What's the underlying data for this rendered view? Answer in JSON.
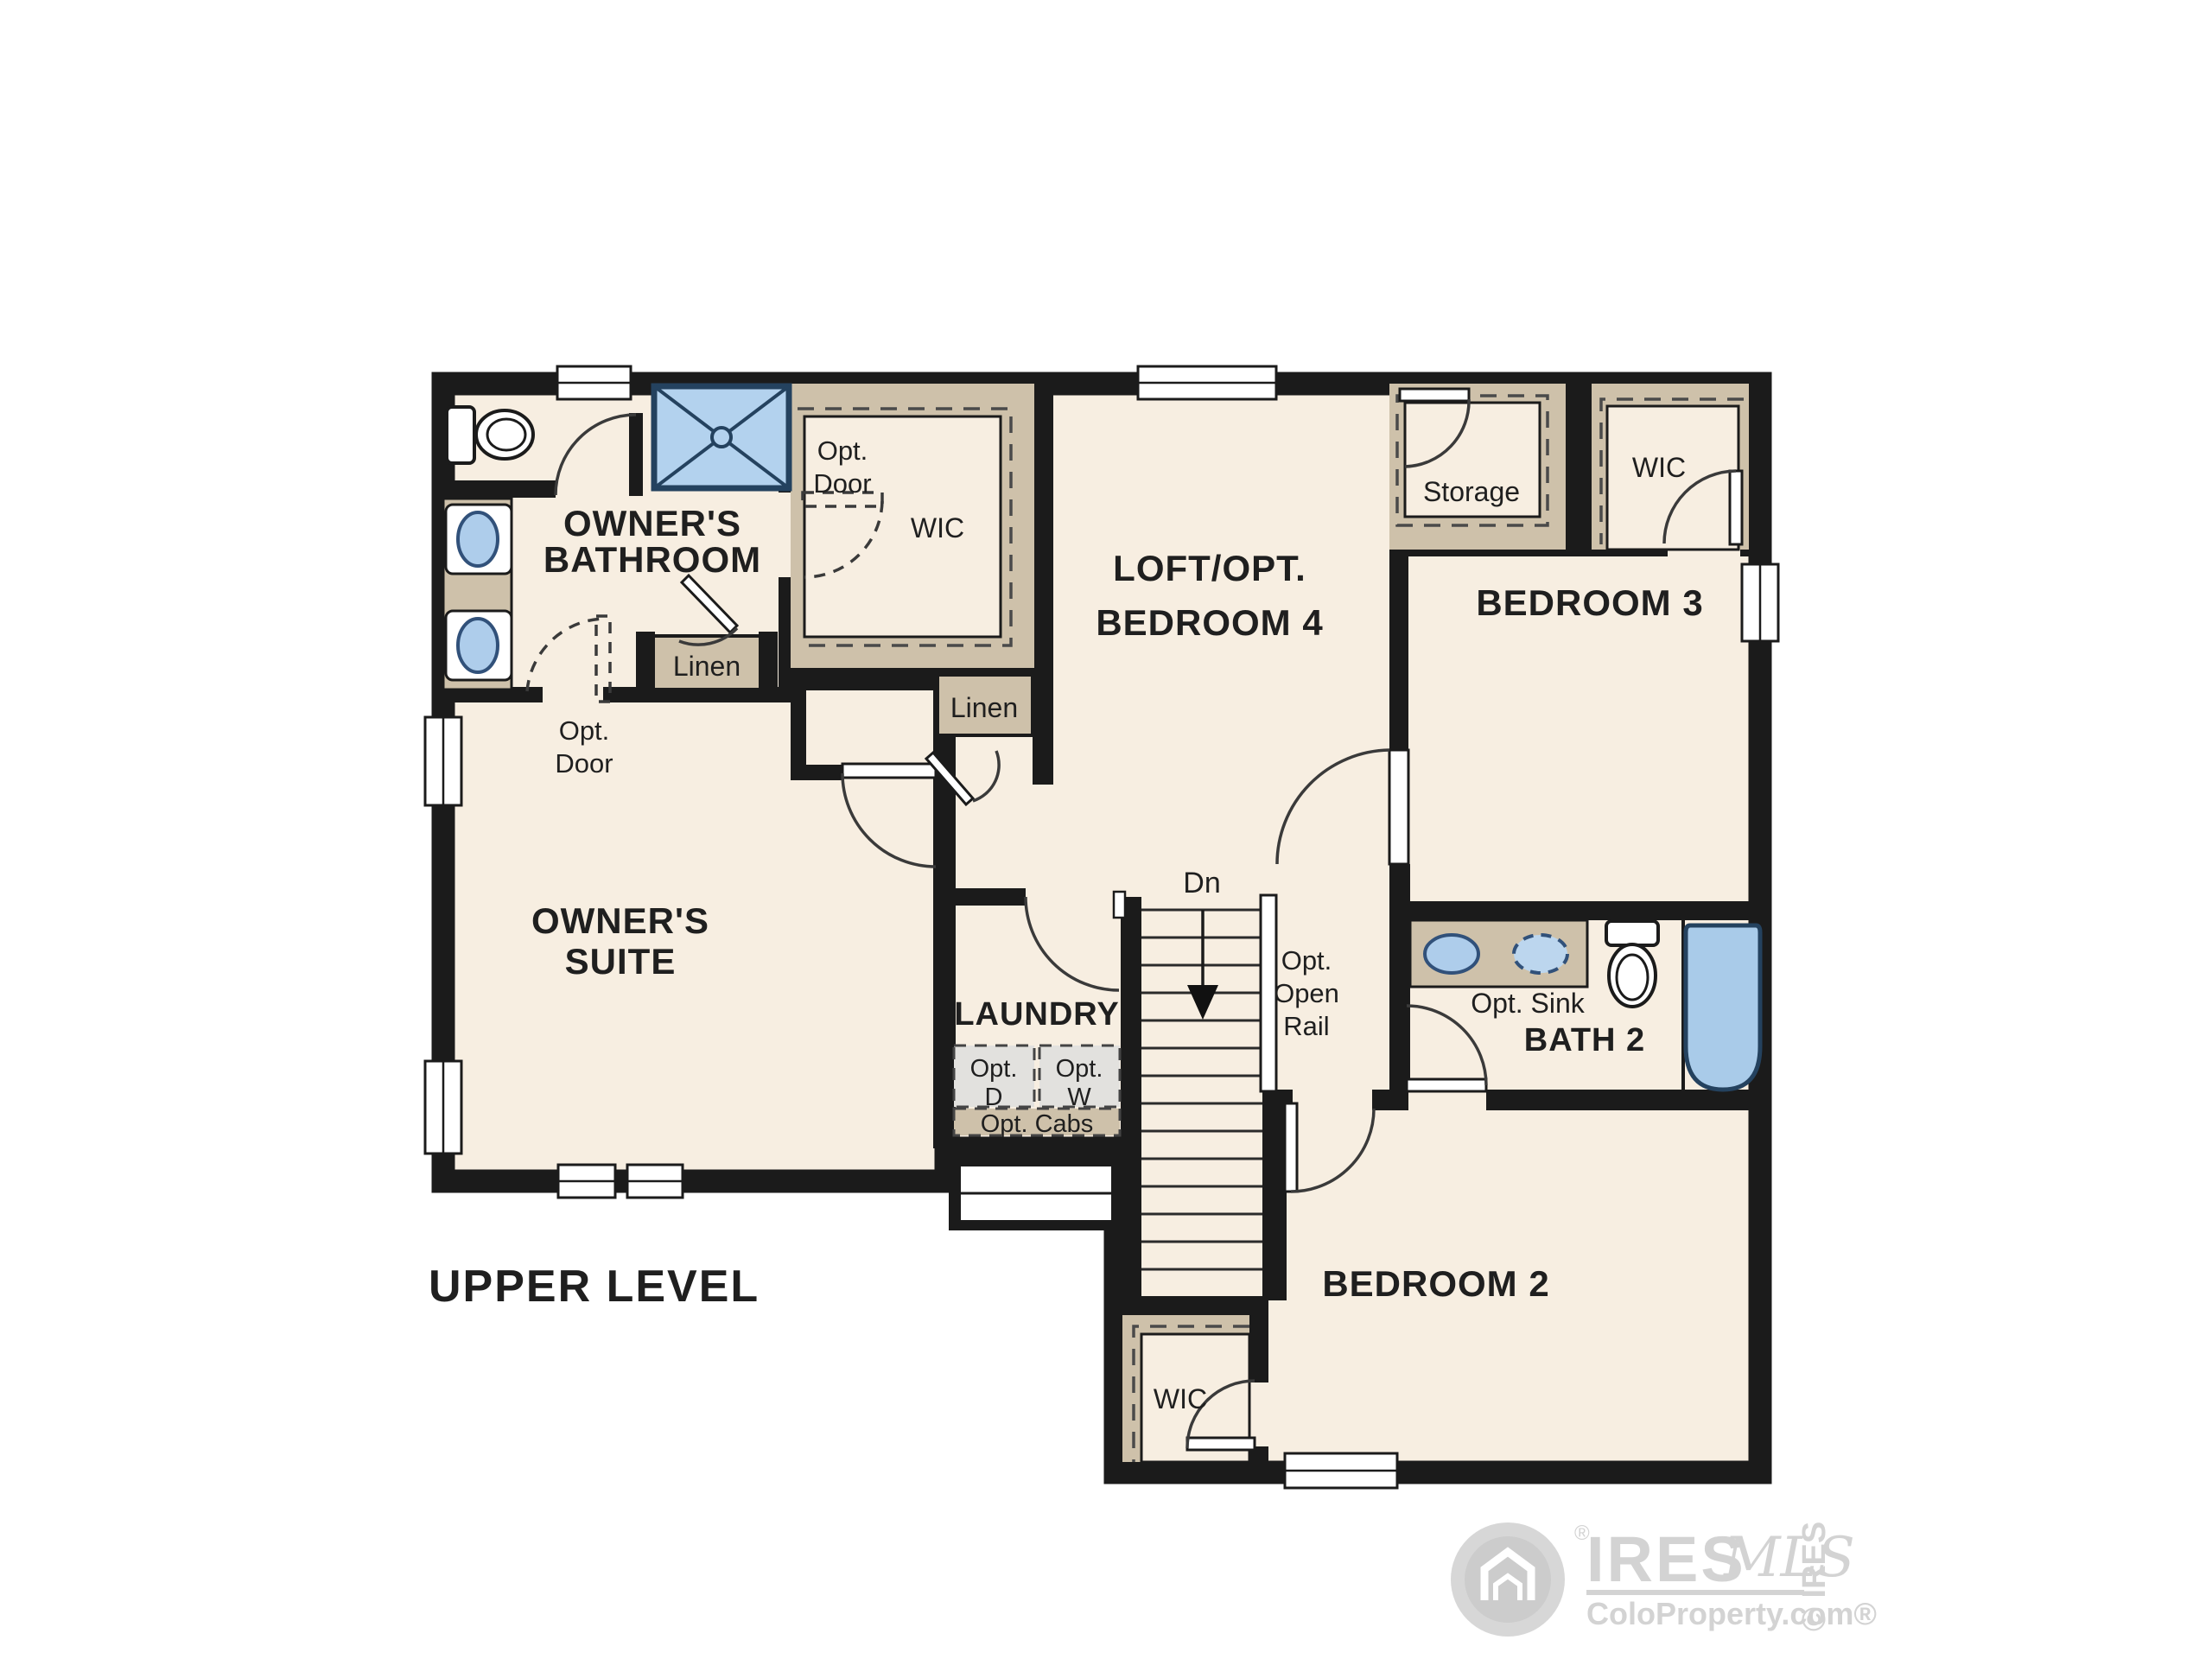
{
  "level_label": "UPPER LEVEL",
  "rooms": {
    "owners_bathroom": {
      "line1": "OWNER'S",
      "line2": "BATHROOM"
    },
    "owners_suite": {
      "line1": "OWNER'S",
      "line2": "SUITE"
    },
    "owners_wic": {
      "label": "WIC"
    },
    "loft": {
      "line1": "LOFT/OPT.",
      "line2": "BEDROOM 4"
    },
    "storage": {
      "label": "Storage"
    },
    "wic_top_right": {
      "label": "WIC"
    },
    "bedroom3": {
      "label": "BEDROOM 3"
    },
    "bath2": {
      "label": "BATH 2",
      "opt_sink": "Opt. Sink"
    },
    "laundry": {
      "label": "LAUNDRY",
      "opt_d_line1": "Opt.",
      "opt_d_line2": "D",
      "opt_w_line1": "Opt.",
      "opt_w_line2": "W",
      "opt_cabs": "Opt. Cabs"
    },
    "bedroom2": {
      "label": "BEDROOM 2"
    },
    "wic_bedroom2": {
      "label": "WIC"
    },
    "linen_bathroom": {
      "label": "Linen"
    },
    "linen_hall": {
      "label": "Linen"
    }
  },
  "stairs": {
    "down_label": "Dn",
    "rail_line1": "Opt.",
    "rail_line2": "Open",
    "rail_line3": "Rail"
  },
  "opt_door_wic": {
    "line1": "Opt.",
    "line2": "Door"
  },
  "opt_door_suite": {
    "line1": "Opt.",
    "line2": "Door"
  },
  "watermark": {
    "brand": "IRES",
    "brand_script": "MLS",
    "site": "ColoProperty.com®",
    "reg": "®",
    "side_text": "© IRES"
  },
  "colors": {
    "floor": "#f7eee1",
    "wall": "#1b1b1b",
    "closet_tan": "#cec1aa",
    "fixture_blue": "#aecdeb",
    "fixture_blue_dark": "#31517a",
    "appliance_gray": "#e2e1de",
    "watermark_gray": "#d3d3d3"
  }
}
